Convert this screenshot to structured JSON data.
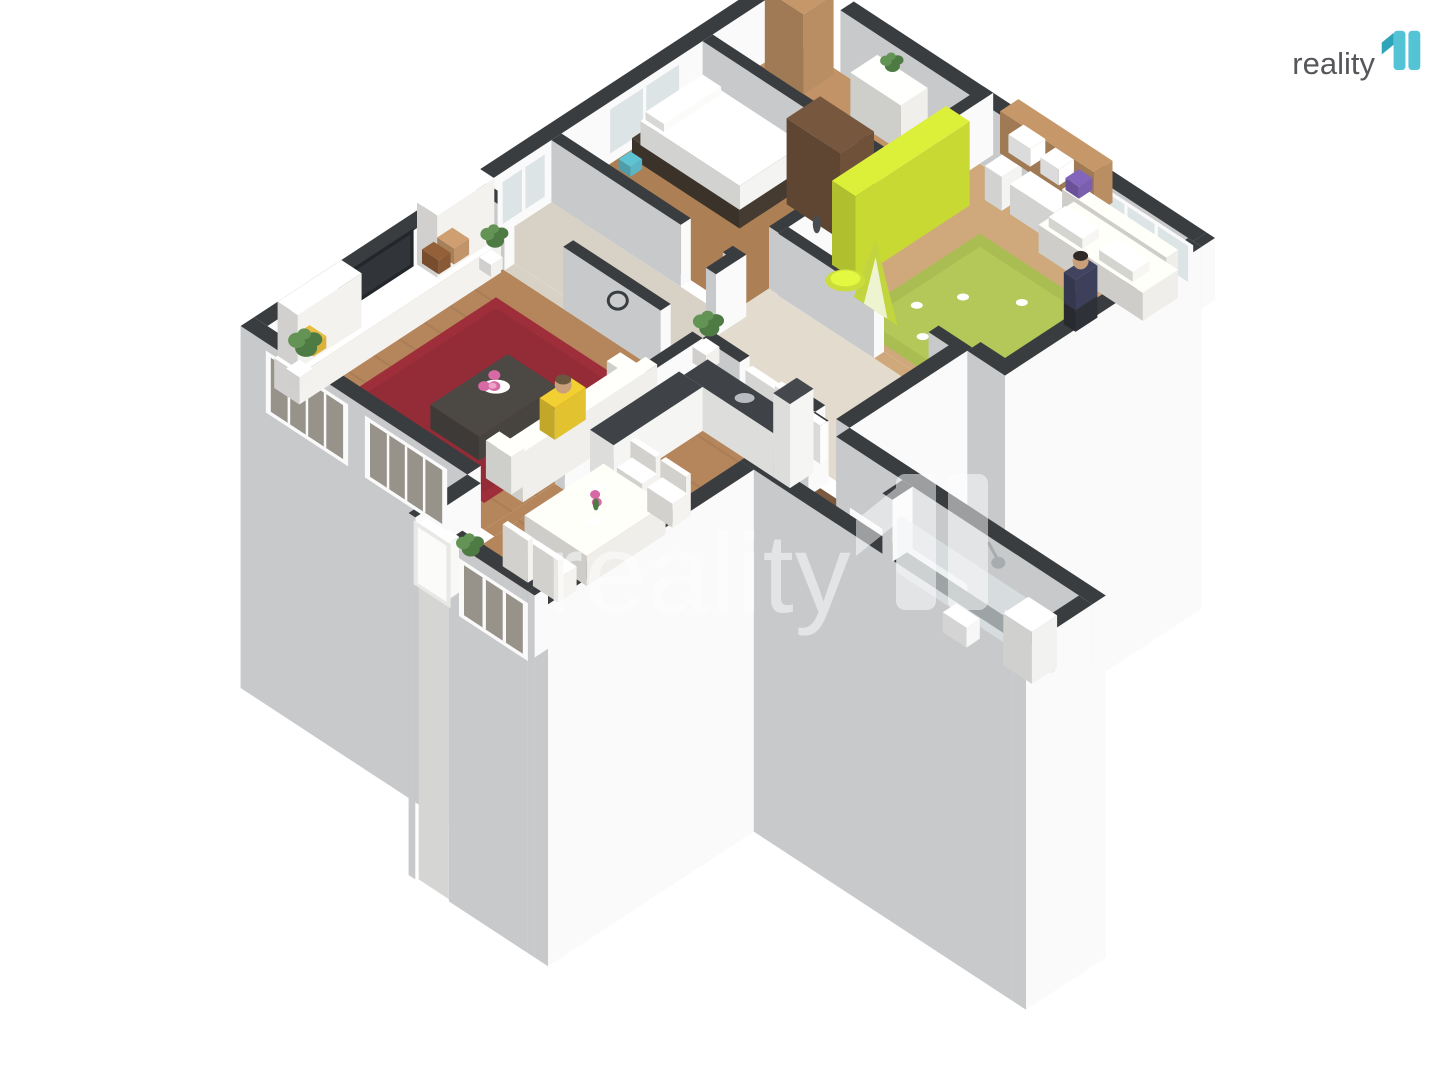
{
  "brand": {
    "name": "reality 11",
    "logo_text": "reality",
    "logo_text_color": "#56575a",
    "teal": "#54c3d5",
    "teal_dark": "#2da4ba"
  },
  "watermark": {
    "text": "reality",
    "color": "#ffffff",
    "opacity": 0.5
  },
  "palette": {
    "background": "#ffffff",
    "wall_top": "#3a3d40",
    "wall_face_light": "#fafafa",
    "wall_face_shadow": "#c7c9cb",
    "plinth_light": "#f3f3f3",
    "plinth_shadow": "#cfcfcf",
    "glass_interior": "#dde4e6",
    "glass_exterior": "#97928a",
    "frame_white": "#fafafa",
    "skin": "#c9a07a",
    "plant_green": "#4e7a43",
    "plant_green_light": "#639455",
    "flower_pink": "#d76aa4",
    "flower_pink_light": "#eda3c8"
  },
  "rooms": [
    {
      "id": "living-room",
      "floor": "#b5855c",
      "rug": "#9e2f3a",
      "sofa": "#f0efeb",
      "shelving": "#f3f2ef",
      "tv": "#23262a",
      "coffee_table": "#474440",
      "person_shirt": "#e3c22f"
    },
    {
      "id": "kitchen-dining",
      "floor": "#b5855c",
      "cabinet": "#f5f5f3",
      "counter_top": "#3f4347",
      "table": "#efeeea",
      "chair": "#f4f3f0"
    },
    {
      "id": "bedroom",
      "floor": "#ad7f54",
      "bed_frame": "#453b31",
      "mattress": "#f4f4f2",
      "wardrobe": "#6f513a",
      "accent_teal": "#5ab6c6"
    },
    {
      "id": "entry-hall",
      "floor": "#c29367",
      "closet": "#b98e62",
      "dresser": "#f0efec"
    },
    {
      "id": "childrens-room",
      "floor": "#cfa97b",
      "rug": "#a9bd53",
      "wardrobe_lime": "#c8d934",
      "shelf": "#b98e62",
      "sofa": "#efeeea",
      "tent": "#c2d53e",
      "tent_inner": "#eef4d0",
      "table_lime": "#cbdd3a",
      "person_outfit": "#3c405a",
      "toy_purple": "#7a5fb0"
    },
    {
      "id": "inner-hall",
      "floor": "#d8d1c6"
    },
    {
      "id": "hallway",
      "floor": "#e2dbce",
      "picture_frame": "#fdfdfd"
    },
    {
      "id": "corridor",
      "floor": "#7a5940"
    },
    {
      "id": "bathroom",
      "floor": "#e9e9e9",
      "tile_dark": "#c3c6c8",
      "tile_light": "#e8eaea",
      "glass_screen": "rgba(225,233,235,0.6)",
      "boiler": "#f2f2f1",
      "fixture": "#a7acae",
      "door_panel": "#f8f8f6"
    }
  ]
}
